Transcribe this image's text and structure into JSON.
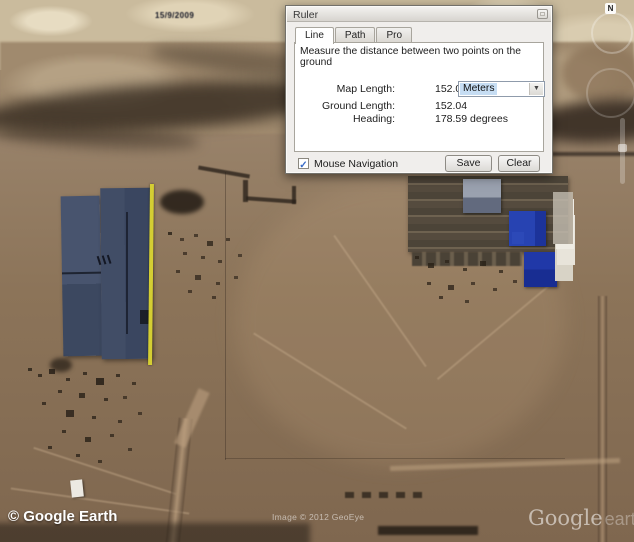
{
  "dialog": {
    "title": "Ruler",
    "tabs": [
      {
        "label": "Line"
      },
      {
        "label": "Path"
      },
      {
        "label": "Pro"
      }
    ],
    "description": "Measure the distance between two points on the ground",
    "fields": [
      {
        "label": "Map Length:",
        "value": "152.01",
        "unit": "Meters"
      },
      {
        "label": "Ground Length:",
        "value": "152.04"
      },
      {
        "label": "Heading:",
        "value": "178.59 degrees"
      }
    ],
    "checkbox": {
      "label": "Mouse Navigation",
      "checked": true,
      "check_glyph": "✓"
    },
    "buttons": {
      "save": "Save",
      "clear": "Clear"
    }
  },
  "map": {
    "date_stamp": "15/9/2009",
    "compass_label": "N",
    "copyright_bar": "© Google Earth",
    "imagery_credit": "Image © 2012 GeoEye",
    "watermark": {
      "brand": "Google",
      "suffix": "earth"
    }
  },
  "colors": {
    "measurement_line": "#d4ce33",
    "warehouse_roof": "#42506b",
    "industrial_blue_panel": "#2440ad",
    "dialog_background": "#f0eeec",
    "combo_selection": "#c6ddf3"
  }
}
